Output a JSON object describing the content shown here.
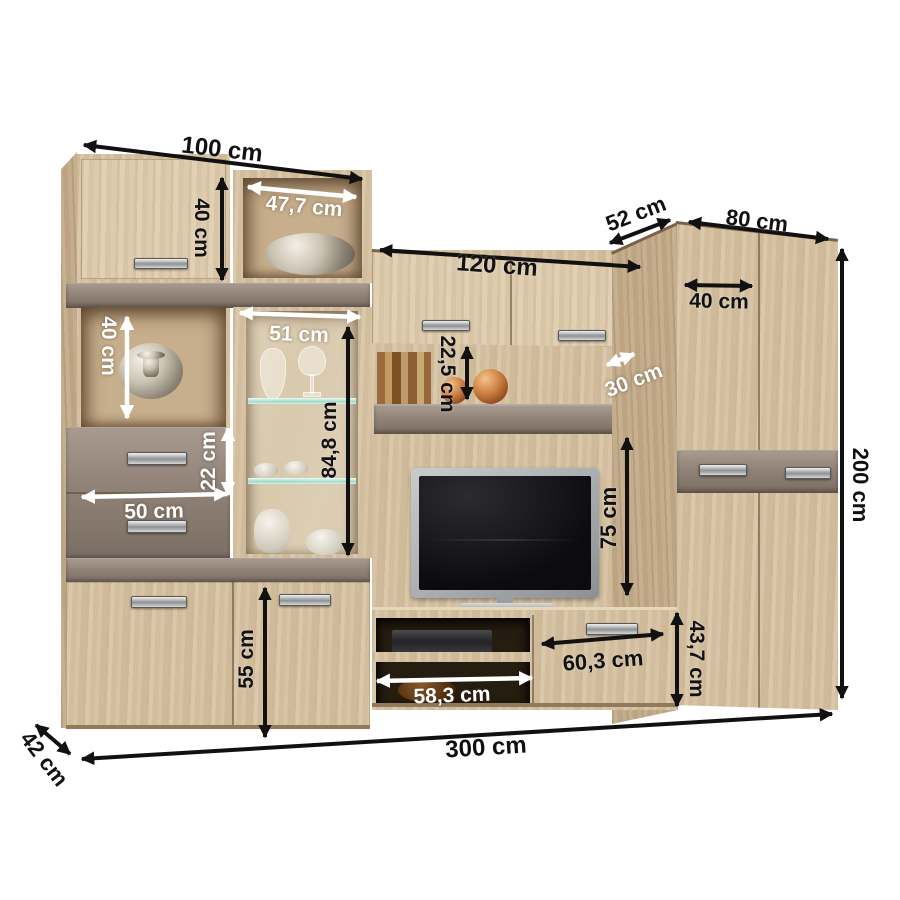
{
  "dimensions": {
    "left_section_width": "100 cm",
    "left_top_door_height": "40 cm",
    "display_niche_width": "47,7 cm",
    "display_case_width": "51 cm",
    "left_niche_height": "40 cm",
    "drawer_height": "22 cm",
    "drawer_width": "50 cm",
    "display_case_glass_height": "84,8 cm",
    "bottom_door_height": "55 cm",
    "bridge_cabinet_width": "120 cm",
    "shelf_gap_height": "22,5 cm",
    "shelf_depth": "30 cm",
    "tv_space_height": "75 cm",
    "wardrobe_depth": "52 cm",
    "wardrobe_width": "80 cm",
    "wardrobe_door_width": "40 cm",
    "total_height": "200 cm",
    "bench_drawer_width": "60,3 cm",
    "bench_niche_width": "58,3 cm",
    "bench_height": "43,7 cm",
    "total_width": "300 cm",
    "total_depth": "42 cm"
  },
  "palette": {
    "background": "#ffffff",
    "wood_light": "#d8c5a6",
    "wood_dark": "#c3ab8a",
    "gloss_taupe": "#8d7f73",
    "label_black": "#111111",
    "label_white": "#ffffff"
  }
}
